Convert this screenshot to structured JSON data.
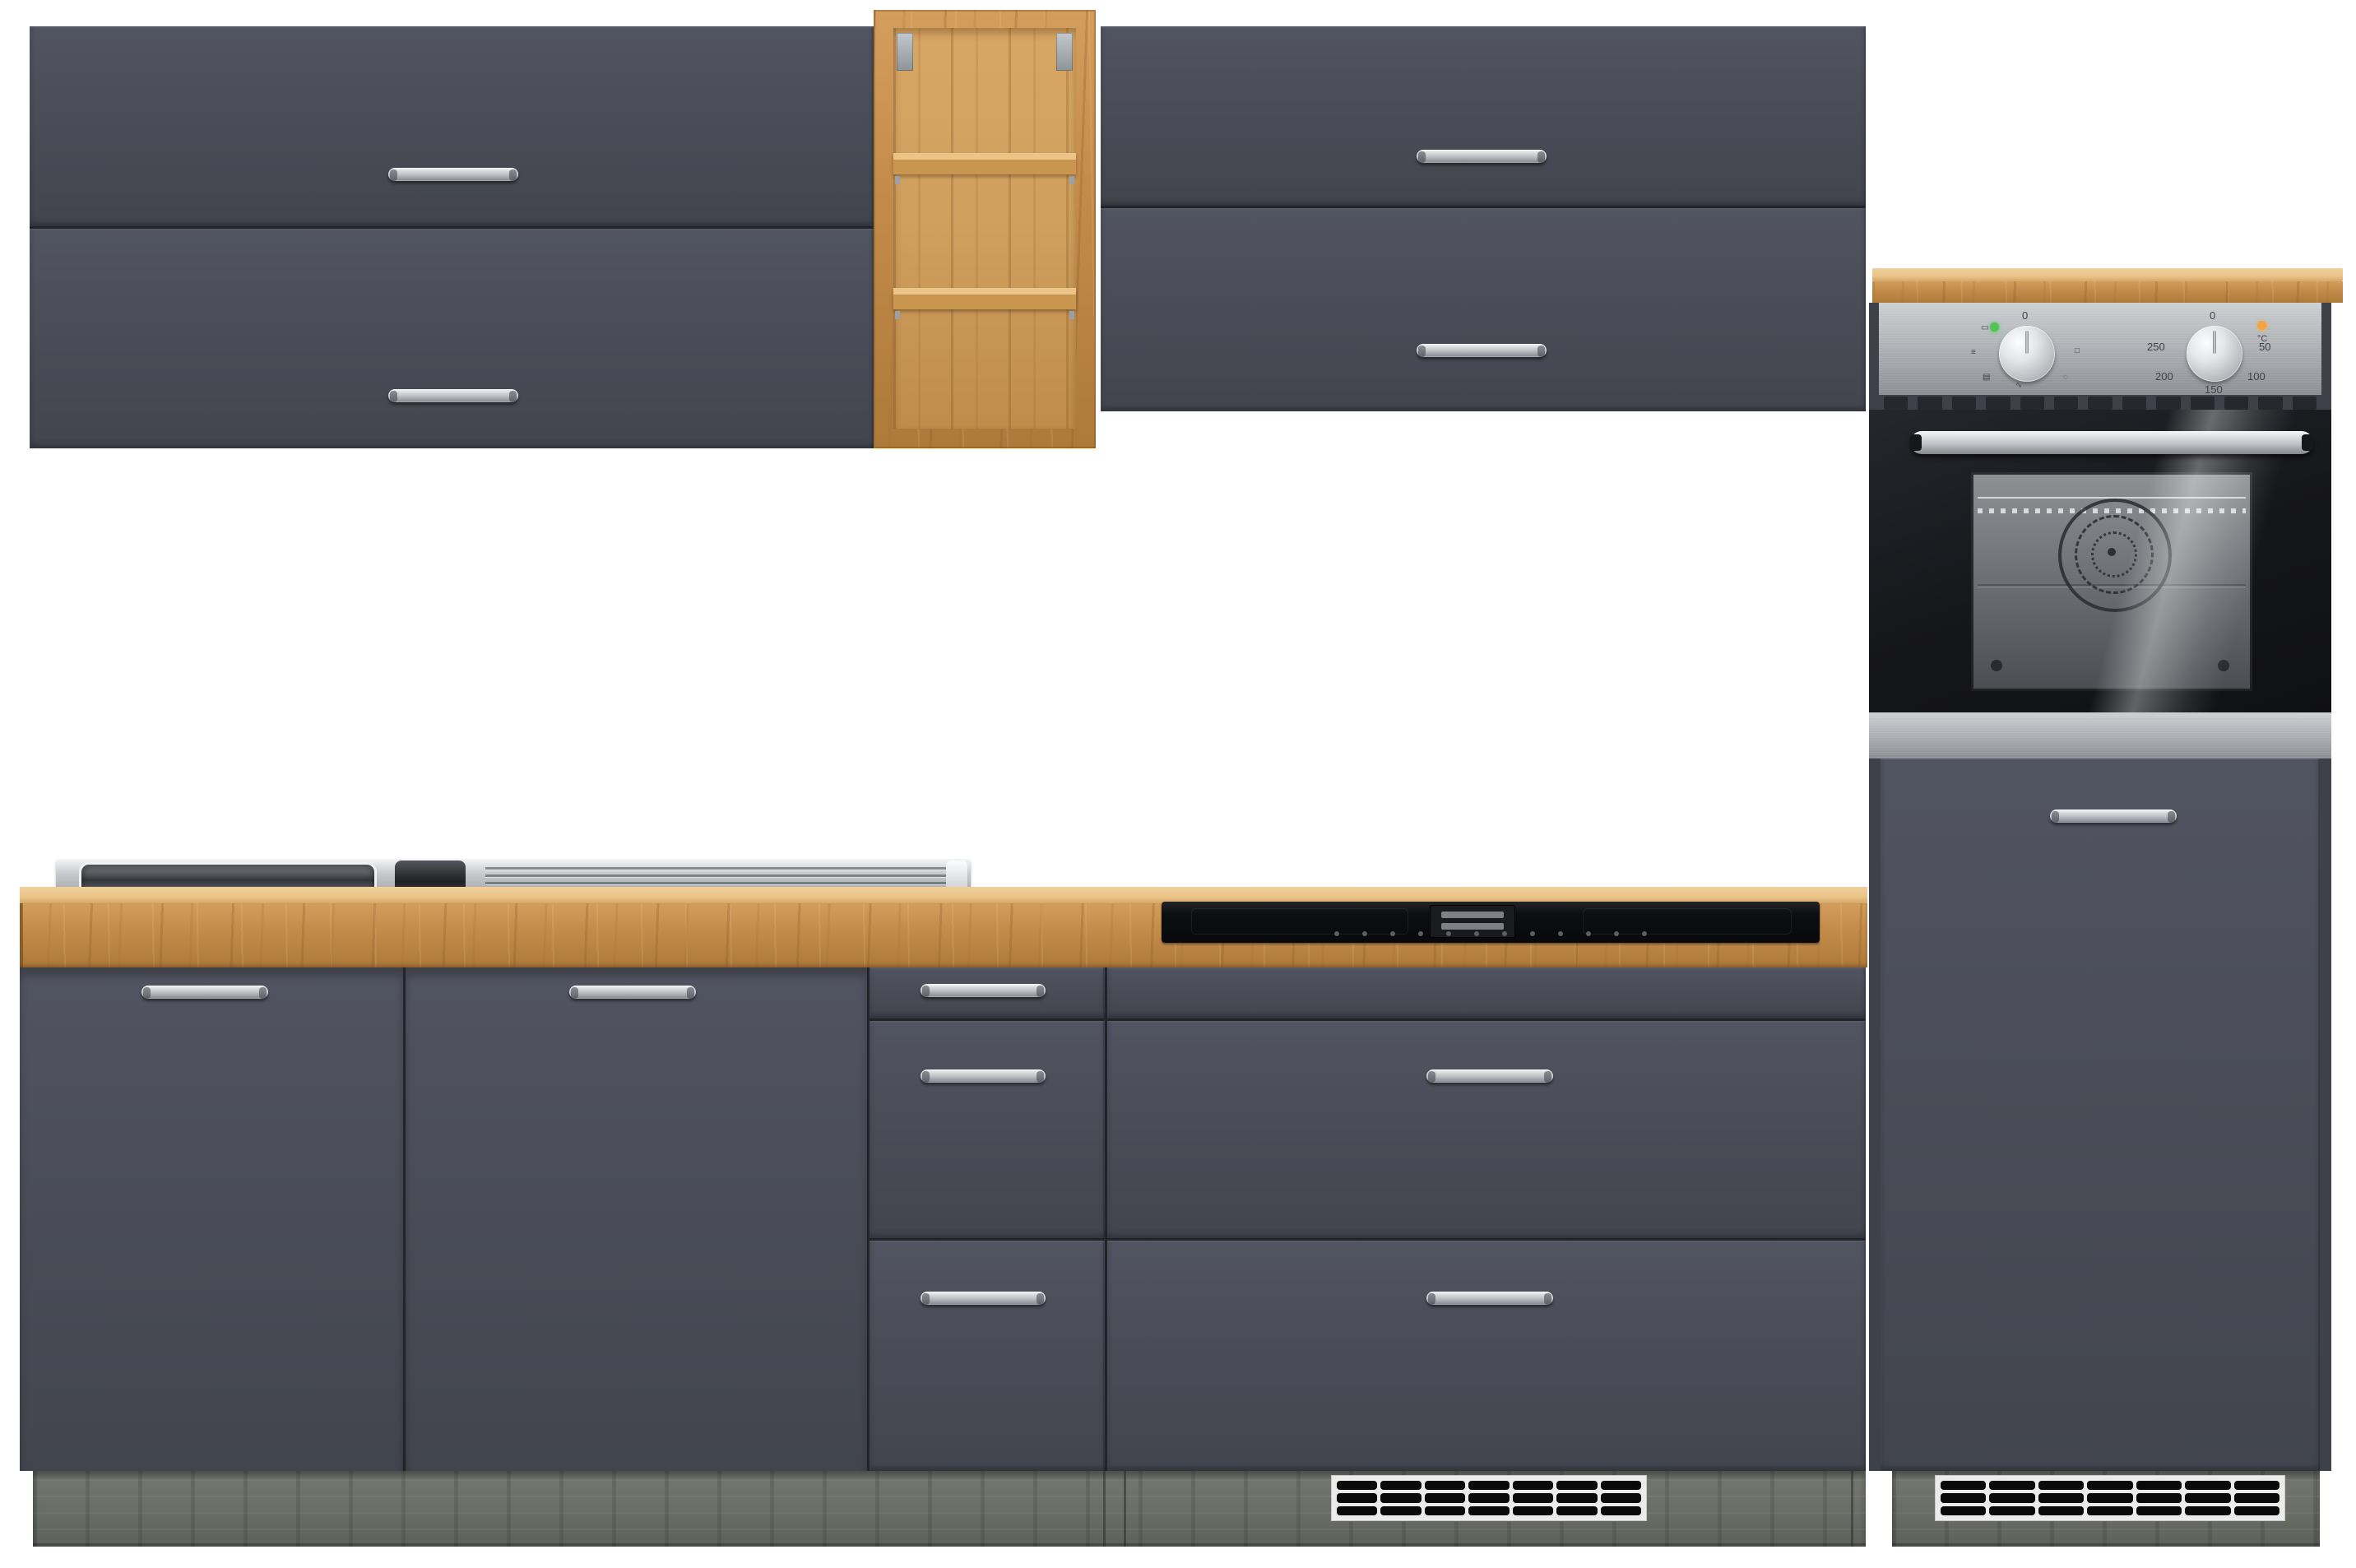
{
  "meta": {
    "description": "Product photo of a grey kitchen cabinet set with oak worktop, open oak wall shelf, stainless sink, black induction hob and built-in stainless oven in a tall cabinet",
    "background": "#ffffff"
  },
  "colors": {
    "front": "#4a4d57",
    "front-hi": "#515461",
    "front-lo": "#42454e",
    "seam": "#22242a",
    "handle-light": "#f2f3f5",
    "handle-mid": "#b9bdc2",
    "handle-dark": "#83878d",
    "oak": "#c48c4a",
    "oak-light": "#eac488",
    "shelf-back": "#cf9f5e",
    "plinth": "#696d66",
    "steel-light": "#ccd0d3",
    "steel": "#a6aaae",
    "steel-dark": "#8b8f94",
    "oven-black": "#16171b",
    "window-grey": "#6f7277",
    "green": "#4fc455",
    "orange": "#f2a53e",
    "grille-frame": "#ebebeb",
    "grille-cell": "#0a0a0b",
    "cooktop": "#0d0e10"
  },
  "oven": {
    "left_knob": {
      "zero": "0",
      "icons": [
        "▭",
        "≡",
        "▤",
        "∿",
        "◌",
        "□"
      ]
    },
    "right_knob": {
      "zero": "0",
      "labels": [
        "250",
        "200",
        "150",
        "100",
        "50"
      ]
    },
    "temp_unit": "°C"
  }
}
